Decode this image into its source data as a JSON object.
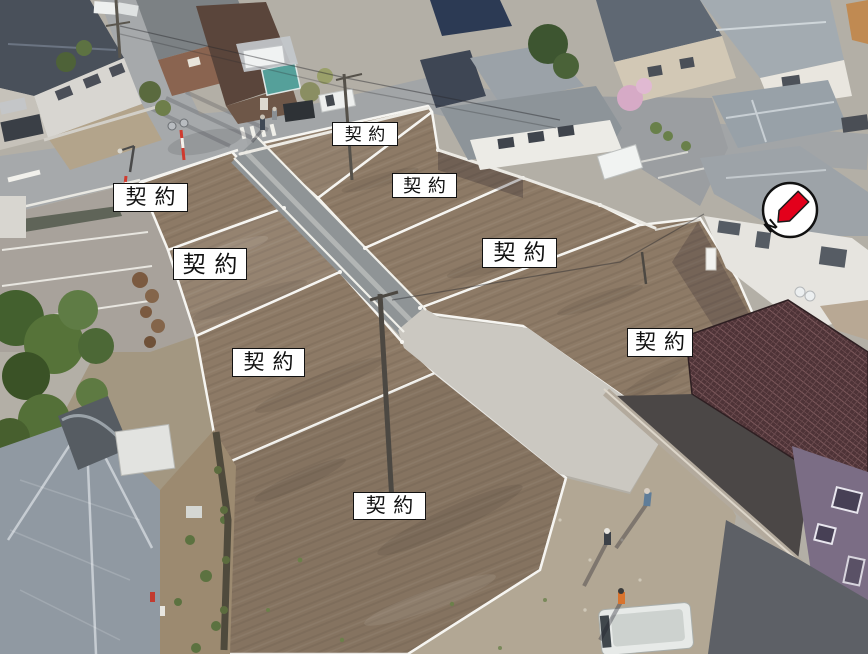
{
  "lot_labels": [
    {
      "text": "契約"
    },
    {
      "text": "契約"
    },
    {
      "text": "契約"
    },
    {
      "text": "契約"
    },
    {
      "text": "契約"
    },
    {
      "text": "契約"
    },
    {
      "text": "契約"
    },
    {
      "text": "契約"
    }
  ],
  "compass": {
    "letter": "N",
    "icon": "north-arrow-icon"
  },
  "colors": {
    "label_bg": "#ffffff",
    "label_border": "#111111",
    "label_text": "#111111",
    "compass_bg": "#ffffff",
    "compass_ring": "#111111",
    "compass_arrow": "#e3001b",
    "dirt": "#8d7a66",
    "asphalt_old": "#a6a9ab",
    "asphalt_new": "#8f9496",
    "concrete_new": "#cbc8c1",
    "gravel": "#b2a794",
    "lot_line": "#f6f5f1"
  }
}
